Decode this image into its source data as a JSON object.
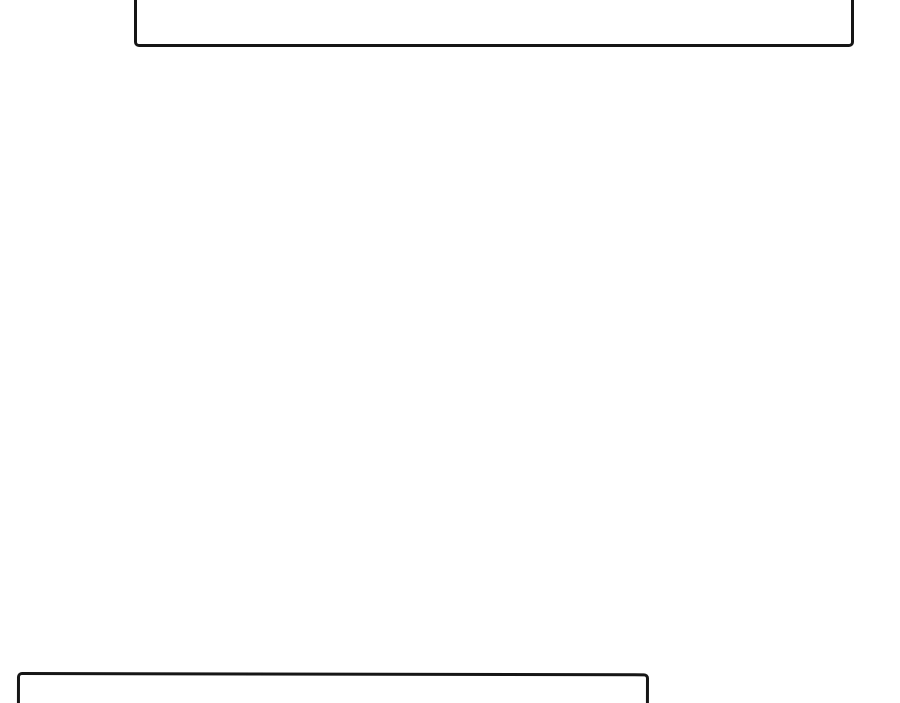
{
  "page": {
    "background_color": "#ffffff",
    "panel_border_color": "#161616",
    "description": "Blank comic/webtoon page region between panels"
  },
  "panels": [
    {
      "name": "top-panel",
      "label": "empty panel, top edge clipped by viewport",
      "content": ""
    },
    {
      "name": "bottom-panel",
      "label": "empty panel, bottom edge clipped by viewport",
      "content": ""
    }
  ]
}
